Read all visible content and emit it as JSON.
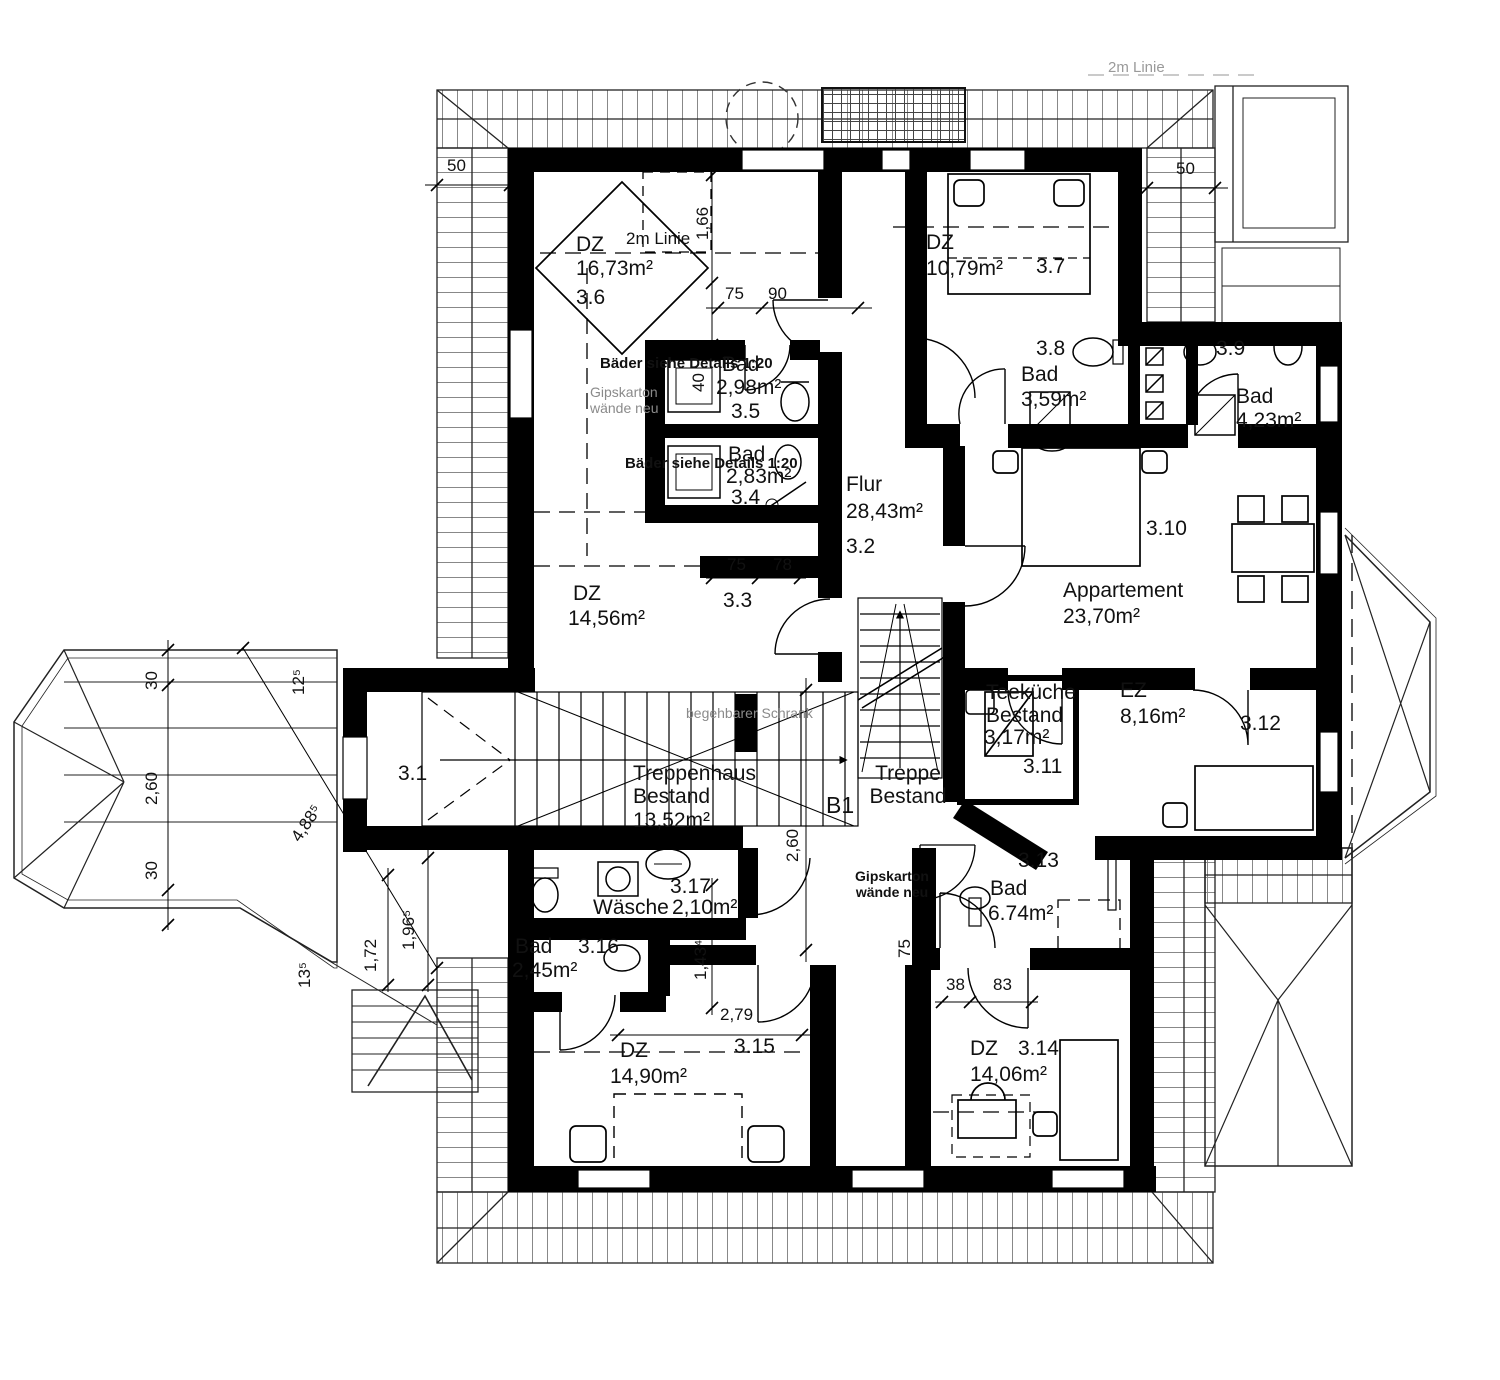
{
  "drawing": {
    "kind": "floor plan",
    "rooms": [
      {
        "id": "3.6",
        "type": "DZ",
        "area": "16,73m²"
      },
      {
        "id": "3.7",
        "type": "DZ",
        "area": "10,79m²"
      },
      {
        "id": "3.8",
        "type": "Bad",
        "area": "3,59m²"
      },
      {
        "id": "3.9",
        "type": "Bad",
        "area": "4,23m²"
      },
      {
        "id": "3.5",
        "type": "Bad",
        "area": "2,98m²"
      },
      {
        "id": "3.4",
        "type": "Bad",
        "area": "2,83m²"
      },
      {
        "id": "3.2",
        "type": "Flur",
        "area": "28,43m²"
      },
      {
        "id": "3.3",
        "type": "DZ",
        "area": "14,56m²"
      },
      {
        "id": "3.10",
        "type": "Appartement",
        "area": "23,70m²"
      },
      {
        "id": "3.11",
        "type": "Teeküche Bestand",
        "area": "3,17m²"
      },
      {
        "id": "3.12",
        "type": "EZ",
        "area": "8,16m²"
      },
      {
        "id": "3.1",
        "type": "Treppenhaus Bestand",
        "area": "13,52m²"
      },
      {
        "id": "3.17",
        "type": "Wäsche",
        "area": "2,10m²"
      },
      {
        "id": "3.16",
        "type": "Bad",
        "area": "2,45m²"
      },
      {
        "id": "3.13",
        "type": "Bad",
        "area": "6.74m²"
      },
      {
        "id": "3.15",
        "type": "DZ",
        "area": "14,90m²"
      },
      {
        "id": "3.14",
        "type": "DZ",
        "area": "14,06m²"
      }
    ],
    "annotations": {
      "two_m_line_room": "2m Linie",
      "two_m_line_top": "2m Linie",
      "bath_detail_note_1": "Bäder siehe Details 1:20",
      "bath_detail_note_2": "Bäder siehe Details 1:20",
      "drywall_note_1": "Gipskarton wände neu",
      "drywall_note_2": "Gipskarton wände neu",
      "walk_in_closet": "begehbarer Schrank",
      "stair_existing": "Treppe Bestand",
      "section_mark": "B1"
    },
    "dimensions": [
      "50",
      "50",
      "1,66",
      "40",
      "75",
      "90",
      "75",
      "78",
      "30",
      "2,60",
      "30",
      "4,88⁵",
      "12⁵",
      "13⁵",
      "1,96⁵",
      "1,72",
      "2,60",
      "1,43⁴",
      "2,79",
      "75",
      "38",
      "83"
    ]
  }
}
